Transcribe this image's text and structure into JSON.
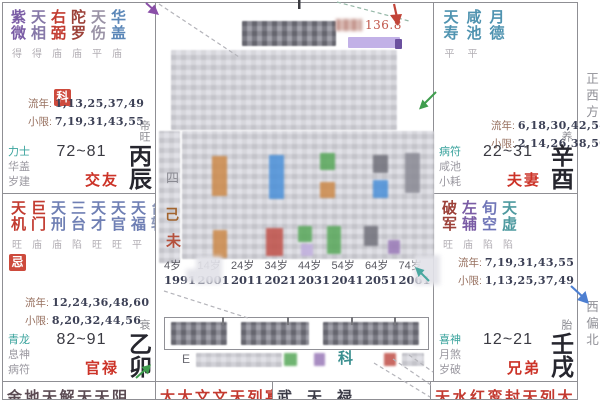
{
  "labels": {
    "liunian": "流年:",
    "xiaoxian": "小限:"
  },
  "margin_labels": {
    "west": "正西方",
    "west_north": "西偏北"
  },
  "palaces": [
    {
      "id": "jiaoyou",
      "stars": [
        {
          "n": "紫微",
          "c": "#7a5ca5",
          "b": "得"
        },
        {
          "n": "天相",
          "c": "#8678a8",
          "b": "得"
        },
        {
          "n": "右弼",
          "c": "#c23b30",
          "b": "庙"
        },
        {
          "n": "陀罗",
          "c": "#9c4038",
          "b": "庙"
        },
        {
          "n": "天伤",
          "c": "#9a93a6",
          "b": "平"
        },
        {
          "n": "华盖",
          "c": "#5b87b8",
          "b": "庙"
        }
      ],
      "badge": "科",
      "liunian": "1,13,25,37,49",
      "xiaoxian": "7,19,31,43,55",
      "gods": [
        "力士",
        "华盖",
        "岁建"
      ],
      "age_range": "72~81",
      "name": "交友",
      "stage": "帝旺",
      "ganzhi": "丙辰"
    },
    {
      "id": "fuqi",
      "stars": [
        {
          "n": "天寿",
          "c": "#4f93b0",
          "b": "平"
        },
        {
          "n": "咸池",
          "c": "#4f93b0",
          "b": "平"
        },
        {
          "n": "月德",
          "c": "#4f93b0",
          "b": ""
        }
      ],
      "badge": "",
      "liunian": "6,18,30,42,54",
      "xiaoxian": "2,14,26,38,50",
      "gods": [
        "病符",
        "咸池",
        "小耗"
      ],
      "age_range": "22~31",
      "name": "夫妻",
      "stage": "养",
      "ganzhi": "辛酉"
    },
    {
      "id": "guanlu",
      "stars": [
        {
          "n": "天机",
          "c": "#c23b30",
          "b": "旺"
        },
        {
          "n": "巨门",
          "c": "#c23b30",
          "b": "庙"
        },
        {
          "n": "天刑",
          "c": "#6f7fb4",
          "b": "庙"
        },
        {
          "n": "三台",
          "c": "#6f7fb4",
          "b": "陷"
        },
        {
          "n": "天才",
          "c": "#6f7fb4",
          "b": "旺"
        },
        {
          "n": "天官",
          "c": "#6f7fb4",
          "b": "旺"
        },
        {
          "n": "天福",
          "c": "#6f7fb4",
          "b": "平"
        },
        {
          "n": "台辅",
          "c": "#8c97b8",
          "b": ""
        }
      ],
      "badge": "忌",
      "liunian": "12,24,36,48,60",
      "xiaoxian": "8,20,32,44,56",
      "gods": [
        "青龙",
        "息神",
        "病符"
      ],
      "age_range": "82~91",
      "name": "官禄",
      "stage": "衰",
      "ganzhi": "乙卯"
    },
    {
      "id": "xiongdi",
      "stars": [
        {
          "n": "破军",
          "c": "#9c4038",
          "b": "旺"
        },
        {
          "n": "左辅",
          "c": "#7a5ca5",
          "b": "庙"
        },
        {
          "n": "旬空",
          "c": "#7076b8",
          "b": "陷"
        },
        {
          "n": "天虚",
          "c": "#4f9aa0",
          "b": "陷"
        }
      ],
      "badge": "",
      "liunian": "7,19,31,43,55",
      "xiaoxian": "1,13,25,37,49",
      "gods": [
        "喜神",
        "月煞",
        "岁破"
      ],
      "age_range": "12~21",
      "name": "兄弟",
      "stage": "胎",
      "ganzhi": "壬戌"
    }
  ],
  "bottom_cells": [
    {
      "text": "金地天解天天阴",
      "color": "#5a4a52"
    },
    {
      "text": "太太文文天列寡破天",
      "color": "#c3392f"
    },
    {
      "text": "武天禄",
      "color": "#3a3a46"
    },
    {
      "text": "天水红鸾封天列大",
      "color": "#c3392f"
    }
  ],
  "center": {
    "score_text": "136.8",
    "ke_mark": "科",
    "e_mark": "E",
    "column_chars": [
      "四",
      "己",
      "未"
    ],
    "ages": [
      "4岁",
      "14岁",
      "24岁",
      "34岁",
      "44岁",
      "54岁",
      "64岁",
      "74岁"
    ],
    "years": [
      "1991",
      "2001",
      "2011",
      "2021",
      "2031",
      "2041",
      "2051",
      "2061"
    ]
  },
  "colors": {
    "dash": "#b4b4ba",
    "dash_teal": "#96b8a8",
    "arrow_red": "#c24438",
    "arrow_purple": "#8a4fa8",
    "arrow_green": "#3f9d4e",
    "arrow_teal": "#49a8a0",
    "arrow_blue": "#4d7fd1",
    "badge_bg": "#cd4a3c",
    "palace_name": "#cc3328",
    "highlight": "#b7a3e3",
    "score": "#c0564a",
    "ke": "#3a8f8f"
  }
}
